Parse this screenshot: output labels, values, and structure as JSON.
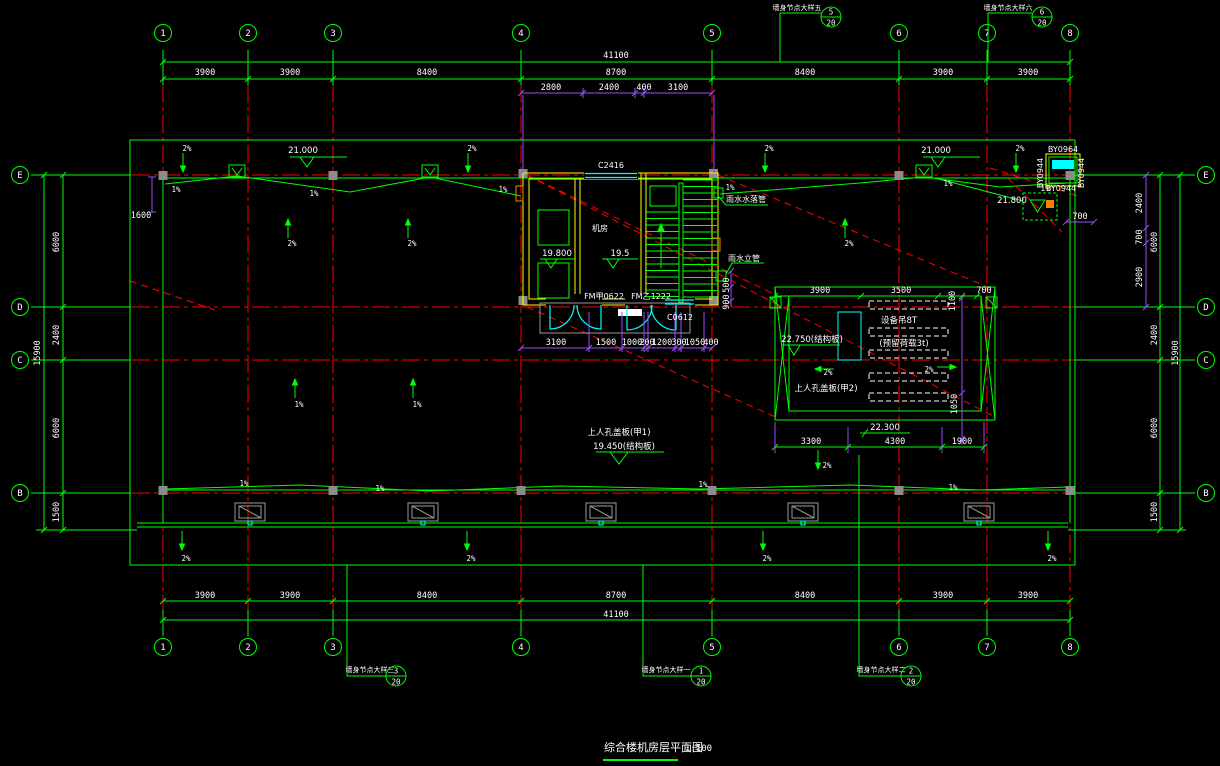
{
  "drawing_title": {
    "name": "综合楼机房层平面图",
    "scale": "1:100"
  },
  "grid": {
    "cols": [
      {
        "t": "1",
        "x": 163
      },
      {
        "t": "2",
        "x": 248
      },
      {
        "t": "3",
        "x": 333
      },
      {
        "t": "4",
        "x": 521
      },
      {
        "t": "5",
        "x": 712
      },
      {
        "t": "6",
        "x": 899
      },
      {
        "t": "7",
        "x": 987
      },
      {
        "t": "8",
        "x": 1070
      }
    ],
    "rows": [
      {
        "t": "E",
        "y": 175
      },
      {
        "t": "D",
        "y": 307
      },
      {
        "t": "C",
        "y": 360
      },
      {
        "t": "B",
        "y": 493
      }
    ]
  },
  "colors": {
    "line_green": "#00ff00",
    "grid_red": "#ff0000",
    "dim_purple": "#9b4dff",
    "window_cyan": "#00ffff",
    "wall_yellow": "#ffff00",
    "text_white": "#ffffff"
  },
  "texts": {
    "dims": [
      {
        "t": "41100",
        "x": 616,
        "y": 58
      },
      {
        "t": "3900",
        "x": 205,
        "y": 75
      },
      {
        "t": "3900",
        "x": 290,
        "y": 75
      },
      {
        "t": "8400",
        "x": 427,
        "y": 75
      },
      {
        "t": "8700",
        "x": 616,
        "y": 75
      },
      {
        "t": "8400",
        "x": 805,
        "y": 75
      },
      {
        "t": "3900",
        "x": 943,
        "y": 75
      },
      {
        "t": "3900",
        "x": 1028,
        "y": 75
      },
      {
        "t": "2800",
        "x": 551,
        "y": 90
      },
      {
        "t": "2400",
        "x": 609,
        "y": 90
      },
      {
        "t": "400",
        "x": 644,
        "y": 90
      },
      {
        "t": "3100",
        "x": 678,
        "y": 90
      },
      {
        "t": "3900",
        "x": 205,
        "y": 598
      },
      {
        "t": "3900",
        "x": 290,
        "y": 598
      },
      {
        "t": "8400",
        "x": 427,
        "y": 598
      },
      {
        "t": "8700",
        "x": 616,
        "y": 598
      },
      {
        "t": "8400",
        "x": 805,
        "y": 598
      },
      {
        "t": "3900",
        "x": 943,
        "y": 598
      },
      {
        "t": "3900",
        "x": 1028,
        "y": 598
      },
      {
        "t": "41100",
        "x": 616,
        "y": 617
      },
      {
        "t": "6000",
        "x": 59,
        "y": 242,
        "r": -90
      },
      {
        "t": "2400",
        "x": 59,
        "y": 335,
        "r": -90
      },
      {
        "t": "6000",
        "x": 59,
        "y": 428,
        "r": -90
      },
      {
        "t": "1500",
        "x": 59,
        "y": 512,
        "r": -90
      },
      {
        "t": "15900",
        "x": 40,
        "y": 353,
        "r": -90
      },
      {
        "t": "1600",
        "x": 141,
        "y": 218,
        "s": 7.5
      },
      {
        "t": "2400",
        "x": 1142,
        "y": 203,
        "r": -90,
        "s": 7.5
      },
      {
        "t": "700",
        "x": 1142,
        "y": 237,
        "r": -90,
        "s": 7.5
      },
      {
        "t": "2900",
        "x": 1142,
        "y": 277,
        "r": -90,
        "s": 7.5
      },
      {
        "t": "6000",
        "x": 1157,
        "y": 242,
        "r": -90
      },
      {
        "t": "2400",
        "x": 1157,
        "y": 335,
        "r": -90
      },
      {
        "t": "6000",
        "x": 1157,
        "y": 428,
        "r": -90
      },
      {
        "t": "1500",
        "x": 1157,
        "y": 512,
        "r": -90
      },
      {
        "t": "15900",
        "x": 1178,
        "y": 353,
        "r": -90
      },
      {
        "t": "700",
        "x": 1080,
        "y": 219,
        "s": 7.5
      },
      {
        "t": "3100",
        "x": 556,
        "y": 345,
        "s": 7
      },
      {
        "t": "1500",
        "x": 606,
        "y": 345,
        "s": 7
      },
      {
        "t": "1000",
        "x": 632,
        "y": 345,
        "s": 7
      },
      {
        "t": "200",
        "x": 647,
        "y": 345,
        "s": 7
      },
      {
        "t": "1200",
        "x": 662,
        "y": 345,
        "s": 7
      },
      {
        "t": "300",
        "x": 679,
        "y": 345,
        "s": 7
      },
      {
        "t": "1050",
        "x": 695,
        "y": 345,
        "s": 7
      },
      {
        "t": "400",
        "x": 711,
        "y": 345,
        "s": 7
      },
      {
        "t": "500",
        "x": 729,
        "y": 285,
        "r": -90,
        "s": 7
      },
      {
        "t": "900",
        "x": 729,
        "y": 302,
        "r": -90,
        "s": 7
      },
      {
        "t": "3900",
        "x": 820,
        "y": 293
      },
      {
        "t": "3500",
        "x": 901,
        "y": 293
      },
      {
        "t": "1100",
        "x": 955,
        "y": 301,
        "r": -90,
        "s": 7
      },
      {
        "t": "700",
        "x": 984,
        "y": 293,
        "s": 7
      },
      {
        "t": "3300",
        "x": 811,
        "y": 444
      },
      {
        "t": "4300",
        "x": 895,
        "y": 444
      },
      {
        "t": "1900",
        "x": 962,
        "y": 444
      },
      {
        "t": "1050",
        "x": 957,
        "y": 404,
        "r": -90,
        "s": 7
      }
    ],
    "levels": [
      {
        "t": "21.000",
        "x": 303,
        "y": 153
      },
      {
        "t": "21.000",
        "x": 936,
        "y": 153
      },
      {
        "t": "21.800",
        "x": 1012,
        "y": 203,
        "s": 8
      },
      {
        "t": "19.800",
        "x": 557,
        "y": 256
      },
      {
        "t": "19.5",
        "x": 620,
        "y": 256
      },
      {
        "t": "上人孔盖板(甲1)",
        "x": 619,
        "y": 435,
        "s": 8
      },
      {
        "t": "19.450(结构板)",
        "x": 624,
        "y": 449
      },
      {
        "t": "22.750(结构板)",
        "x": 812,
        "y": 342
      },
      {
        "t": "22.300",
        "x": 885,
        "y": 430
      },
      {
        "t": "上人孔盖板(甲2)",
        "x": 826,
        "y": 391,
        "s": 8
      },
      {
        "t": "设备吊8T",
        "x": 899,
        "y": 323,
        "s": 7.5
      },
      {
        "t": "(预留荷载3t)",
        "x": 904,
        "y": 346,
        "s": 7.5
      }
    ],
    "labels": [
      {
        "t": "C2416",
        "x": 611,
        "y": 168,
        "s": 7.5
      },
      {
        "t": "C0612",
        "x": 680,
        "y": 320,
        "s": 7.5
      },
      {
        "t": "FM甲0622",
        "x": 604,
        "y": 299,
        "s": 7
      },
      {
        "t": "FM乙1222",
        "x": 651,
        "y": 299,
        "s": 7
      },
      {
        "t": "机房",
        "x": 600,
        "y": 231
      },
      {
        "t": "雨水水落管",
        "x": 746,
        "y": 202,
        "s": 7.5
      },
      {
        "t": "雨水立管",
        "x": 744,
        "y": 261,
        "s": 7.5
      },
      {
        "t": "BY0964",
        "x": 1063,
        "y": 152,
        "s": 6
      },
      {
        "t": "BY0944",
        "x": 1043,
        "y": 173,
        "r": -90,
        "s": 6
      },
      {
        "t": "BY0944",
        "x": 1084,
        "y": 173,
        "r": -90,
        "s": 6
      },
      {
        "t": "BY0944",
        "x": 1061,
        "y": 191,
        "s": 6
      }
    ],
    "slopes": [
      {
        "t": "2%",
        "x": 187,
        "y": 151
      },
      {
        "t": "2%",
        "x": 472,
        "y": 151
      },
      {
        "t": "2%",
        "x": 769,
        "y": 151
      },
      {
        "t": "2%",
        "x": 1020,
        "y": 151
      },
      {
        "t": "2%",
        "x": 292,
        "y": 246
      },
      {
        "t": "2%",
        "x": 412,
        "y": 246
      },
      {
        "t": "2%",
        "x": 849,
        "y": 246
      },
      {
        "t": "1%",
        "x": 299,
        "y": 407
      },
      {
        "t": "1%",
        "x": 417,
        "y": 407
      },
      {
        "t": "2%",
        "x": 186,
        "y": 561
      },
      {
        "t": "2%",
        "x": 471,
        "y": 561
      },
      {
        "t": "2%",
        "x": 767,
        "y": 561
      },
      {
        "t": "2%",
        "x": 1052,
        "y": 561
      },
      {
        "t": "2%",
        "x": 828,
        "y": 375
      },
      {
        "t": "2%",
        "x": 929,
        "y": 372
      },
      {
        "t": "2%",
        "x": 827,
        "y": 468
      },
      {
        "t": "1%",
        "x": 176,
        "y": 192
      },
      {
        "t": "1%",
        "x": 314,
        "y": 196
      },
      {
        "t": "1%",
        "x": 503,
        "y": 192
      },
      {
        "t": "1%",
        "x": 730,
        "y": 190
      },
      {
        "t": "1%",
        "x": 948,
        "y": 186
      },
      {
        "t": "1%",
        "x": 1045,
        "y": 191
      },
      {
        "t": "1%",
        "x": 244,
        "y": 486
      },
      {
        "t": "1%",
        "x": 380,
        "y": 491
      },
      {
        "t": "1%",
        "x": 703,
        "y": 487
      },
      {
        "t": "1%",
        "x": 953,
        "y": 490
      }
    ]
  },
  "callouts": [
    {
      "label": "墙身节点大样五",
      "num": "5",
      "den": "20"
    },
    {
      "label": "墙身节点大样六",
      "num": "6",
      "den": "20"
    },
    {
      "label": "墙身节点大样三",
      "num": "3",
      "den": "20"
    },
    {
      "label": "墙身节点大样一",
      "num": "1",
      "den": "20"
    },
    {
      "label": "墙身节点大样二",
      "num": "2",
      "den": "20"
    }
  ]
}
